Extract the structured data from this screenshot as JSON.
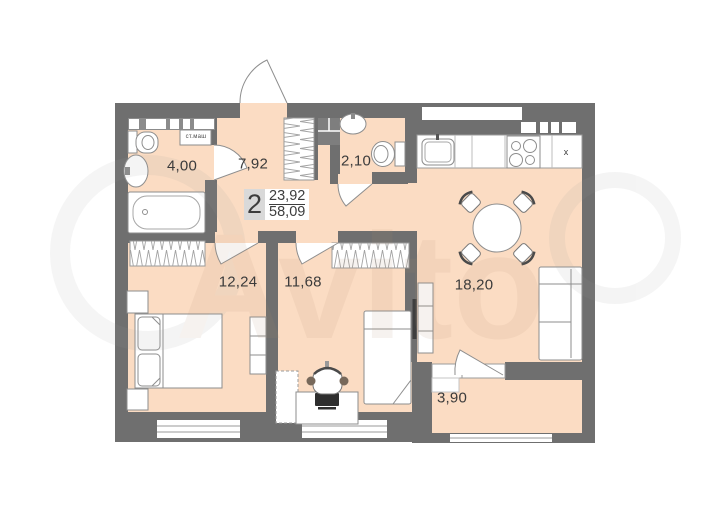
{
  "summary": {
    "rooms_count": "2",
    "living_area": "23,92",
    "total_area": "58,09"
  },
  "rooms": {
    "bathroom": "4,00",
    "hallway": "7,92",
    "wc": "2,10",
    "bedroom": "12,24",
    "kids_room": "11,68",
    "kitchen_living": "18,20",
    "balcony": "3,90"
  },
  "labels": {
    "washing_machine": "ст.маш",
    "vent_mark": "x"
  },
  "watermark": "Avito",
  "colors": {
    "wall": "#6f6f6f",
    "floor": "#fbdcc3",
    "furniture_stroke": "#8e8e8e",
    "window": "#cccccc"
  }
}
